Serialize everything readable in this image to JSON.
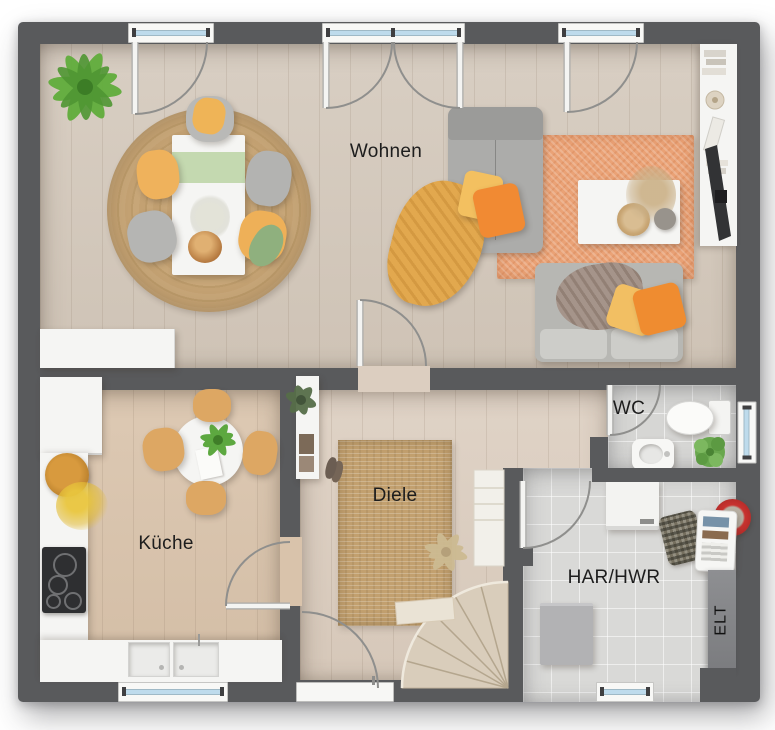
{
  "floorplan": {
    "type": "ground-floor-plan",
    "rooms": [
      {
        "id": "wohnen",
        "label": "Wohnen"
      },
      {
        "id": "kueche",
        "label": "Küche"
      },
      {
        "id": "diele",
        "label": "Diele"
      },
      {
        "id": "wc",
        "label": "WC"
      },
      {
        "id": "har_hwr",
        "label": "HAR/HWR"
      },
      {
        "id": "elt",
        "label": "ELT"
      }
    ],
    "colors": {
      "wall": "#595a5c",
      "wood_living": "#d4c9bc",
      "wood_kitchen": "#d9c3ab",
      "wood_hall": "#dccec0",
      "tile_gray": "#d9d9d7",
      "rug_jute": "#c2a06f",
      "rug_orange": "#eaa276",
      "accent_yellow": "#f0b35e",
      "accent_orange": "#ef8c2e",
      "accent_green": "#61ad3c",
      "window_glass": "#bedbec"
    },
    "features": {
      "windows_top": 3,
      "windows_bottom": 2,
      "windows_right": 1,
      "entrance_door": "bottom-center",
      "staircase": "winder-bottom-center-right"
    }
  }
}
